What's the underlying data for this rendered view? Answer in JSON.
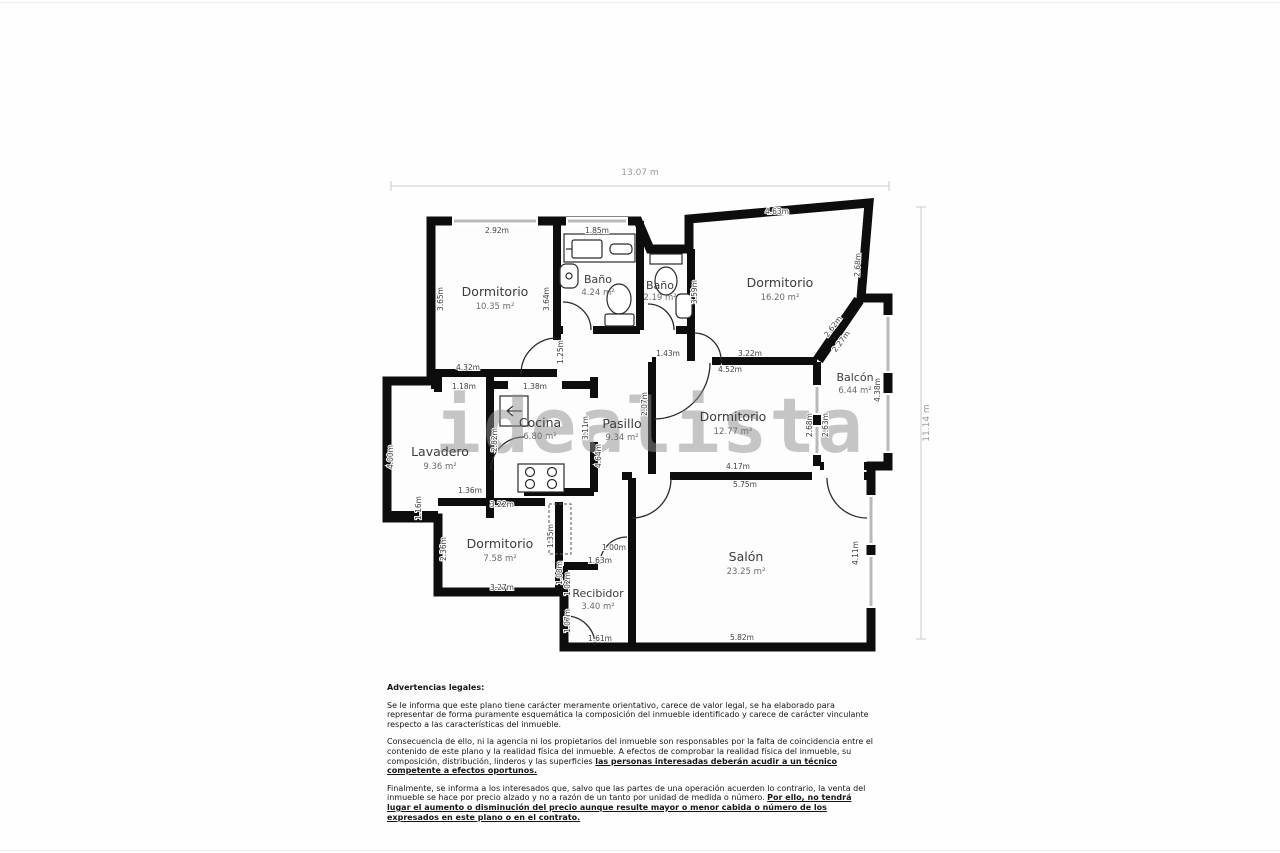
{
  "watermark": "idealista",
  "overall": {
    "width_label": "13.07 m",
    "height_label": "11.14 m"
  },
  "rooms": {
    "dorm_a": {
      "name": "Dormitorio",
      "area": "10.35 m²"
    },
    "bano_a": {
      "name": "Baño",
      "area": "4.24 m²"
    },
    "bano_b": {
      "name": "Baño",
      "area": "2.19 m²"
    },
    "dorm_c": {
      "name": "Dormitorio",
      "area": "16.20 m²"
    },
    "balcon": {
      "name": "Balcón",
      "area": "6.44 m²"
    },
    "dorm_d": {
      "name": "Dormitorio",
      "area": "12.77 m²"
    },
    "lavadero": {
      "name": "Lavadero",
      "area": "9.36 m²"
    },
    "cocina": {
      "name": "Cocina",
      "area": "6.80 m²"
    },
    "pasillo": {
      "name": "Pasillo",
      "area": "9.34 m²"
    },
    "dorm_b": {
      "name": "Dormitorio",
      "area": "7.58 m²"
    },
    "recibidor": {
      "name": "Recibidor",
      "area": "3.40 m²"
    },
    "salon": {
      "name": "Salón",
      "area": "23.25 m²"
    }
  },
  "dims": {
    "dormA_top": "2.92m",
    "dormA_left": "3.65m",
    "dormA_right": "3.64m",
    "dormA_bottom": "4.32m",
    "dormA_door": "1.25m",
    "banoA_top": "1.85m",
    "banoB_right": "3.59m",
    "lav_opening": "1.18m",
    "coc_opening": "1.38m",
    "dormC_top": "4.63m",
    "dormC_right": "2.68m",
    "dormC_diag_out": "2.62m",
    "dormC_diag_in": "2.27m",
    "dormC_bottom": "3.22m",
    "dormD_gap": "1.43m",
    "dormD_top": "4.52m",
    "dormD_left": "2.07m",
    "dormD_bottom": "4.17m",
    "balcon_left_a": "2.68m",
    "balcon_left_b": "2.63m",
    "balcon_right": "4.38m",
    "lav_left": "4.00m",
    "lav_right": "2.82m",
    "lav_bottom": "1.36m",
    "lav_bottom_left": "1.16m",
    "coc_right": "3.11m",
    "pas_left": "4.64m",
    "dormB_top": "3.22m",
    "dormB_left": "2.36m",
    "dormB_bottom": "3.27m",
    "dormB_right": "1.35m",
    "dormB_right2": "1.08m",
    "rec_gap": "1.00m",
    "rec_top": "1.63m",
    "rec_left_a": "1.02m",
    "rec_left_b": "1.07m",
    "rec_bottom": "1.61m",
    "salon_top": "5.75m",
    "salon_bottom": "5.82m",
    "salon_right": "4.11m"
  },
  "legal": {
    "heading": "Advertencias legales:",
    "p1": "Se le informa que este plano tiene carácter meramente orientativo, carece de valor legal, se ha elaborado para representar de forma puramente esquemática la composición del inmueble identificado y carece de carácter vinculante respecto a las características del inmueble.",
    "p2_normal": "Consecuencia de ello, ni la agencia ni los propietarios del inmueble son responsables por la falta de coincidencia entre el contenido de este plano y la realidad física del inmueble. A efectos de comprobar la realidad física del inmueble, su composición, distribución, linderos y las superficies",
    "p2_bold": "las personas interesadas deberán acudir a un técnico competente a efectos oportunos.",
    "p3_normal": "Finalmente, se informa a los interesados que, salvo que las partes de una operación acuerden lo contrario, la venta del inmueble se hace por precio alzado y no a razón de un tanto por unidad de medida o número.",
    "p3_bold": "Por ello, no tendrá lugar el aumento o disminución del precio aunque resulte mayor o menor cabida o número de los expresados en este plano o en el contrato."
  }
}
